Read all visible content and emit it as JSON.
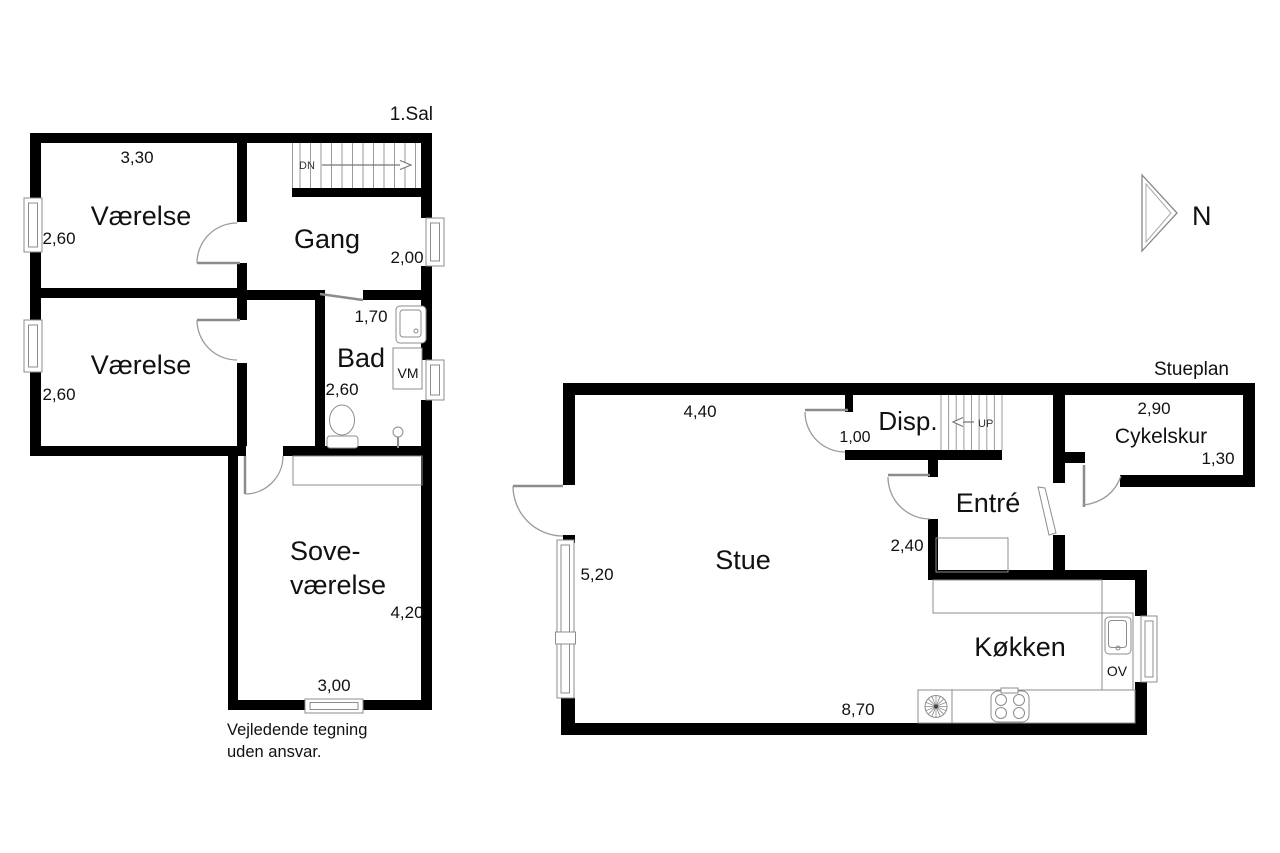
{
  "drawing": {
    "footer_line1": "Vejledende tegning",
    "footer_line2": "uden ansvar.",
    "north_label": "N",
    "colors": {
      "wall": "#000000",
      "fixture_line": "#8c8c8c",
      "text": "#111111",
      "background": "#ffffff"
    }
  },
  "upper_floor": {
    "title": "1.Sal",
    "stairs_label": "DN",
    "washing_machine_label": "VM",
    "rooms": {
      "vaerelse1": {
        "label": "Værelse",
        "dim_width": "3,30",
        "dim_height": "2,60"
      },
      "vaerelse2": {
        "label": "Værelse",
        "dim_height": "2,60"
      },
      "gang": {
        "label": "Gang",
        "dim_width": "2,00"
      },
      "bad": {
        "label": "Bad",
        "dim_width": "1,70",
        "dim_height": "2,60"
      },
      "sovevaerelse": {
        "label_line1": "Sove-",
        "label_line2": "værelse",
        "dim_height": "4,20",
        "dim_width": "3,00"
      }
    }
  },
  "ground_floor": {
    "title": "Stueplan",
    "stairs_label": "UP",
    "oven_label": "OV",
    "rooms": {
      "stue": {
        "label": "Stue",
        "dim_width": "4,40",
        "dim_height": "5,20"
      },
      "disp": {
        "label": "Disp.",
        "dim": "1,00"
      },
      "entre": {
        "label": "Entré",
        "dim": "2,40"
      },
      "cykelskur": {
        "label": "Cykelskur",
        "dim_width": "2,90",
        "dim_height": "1,30"
      },
      "koekken": {
        "label": "Køkken",
        "dim_width": "8,70"
      }
    }
  }
}
